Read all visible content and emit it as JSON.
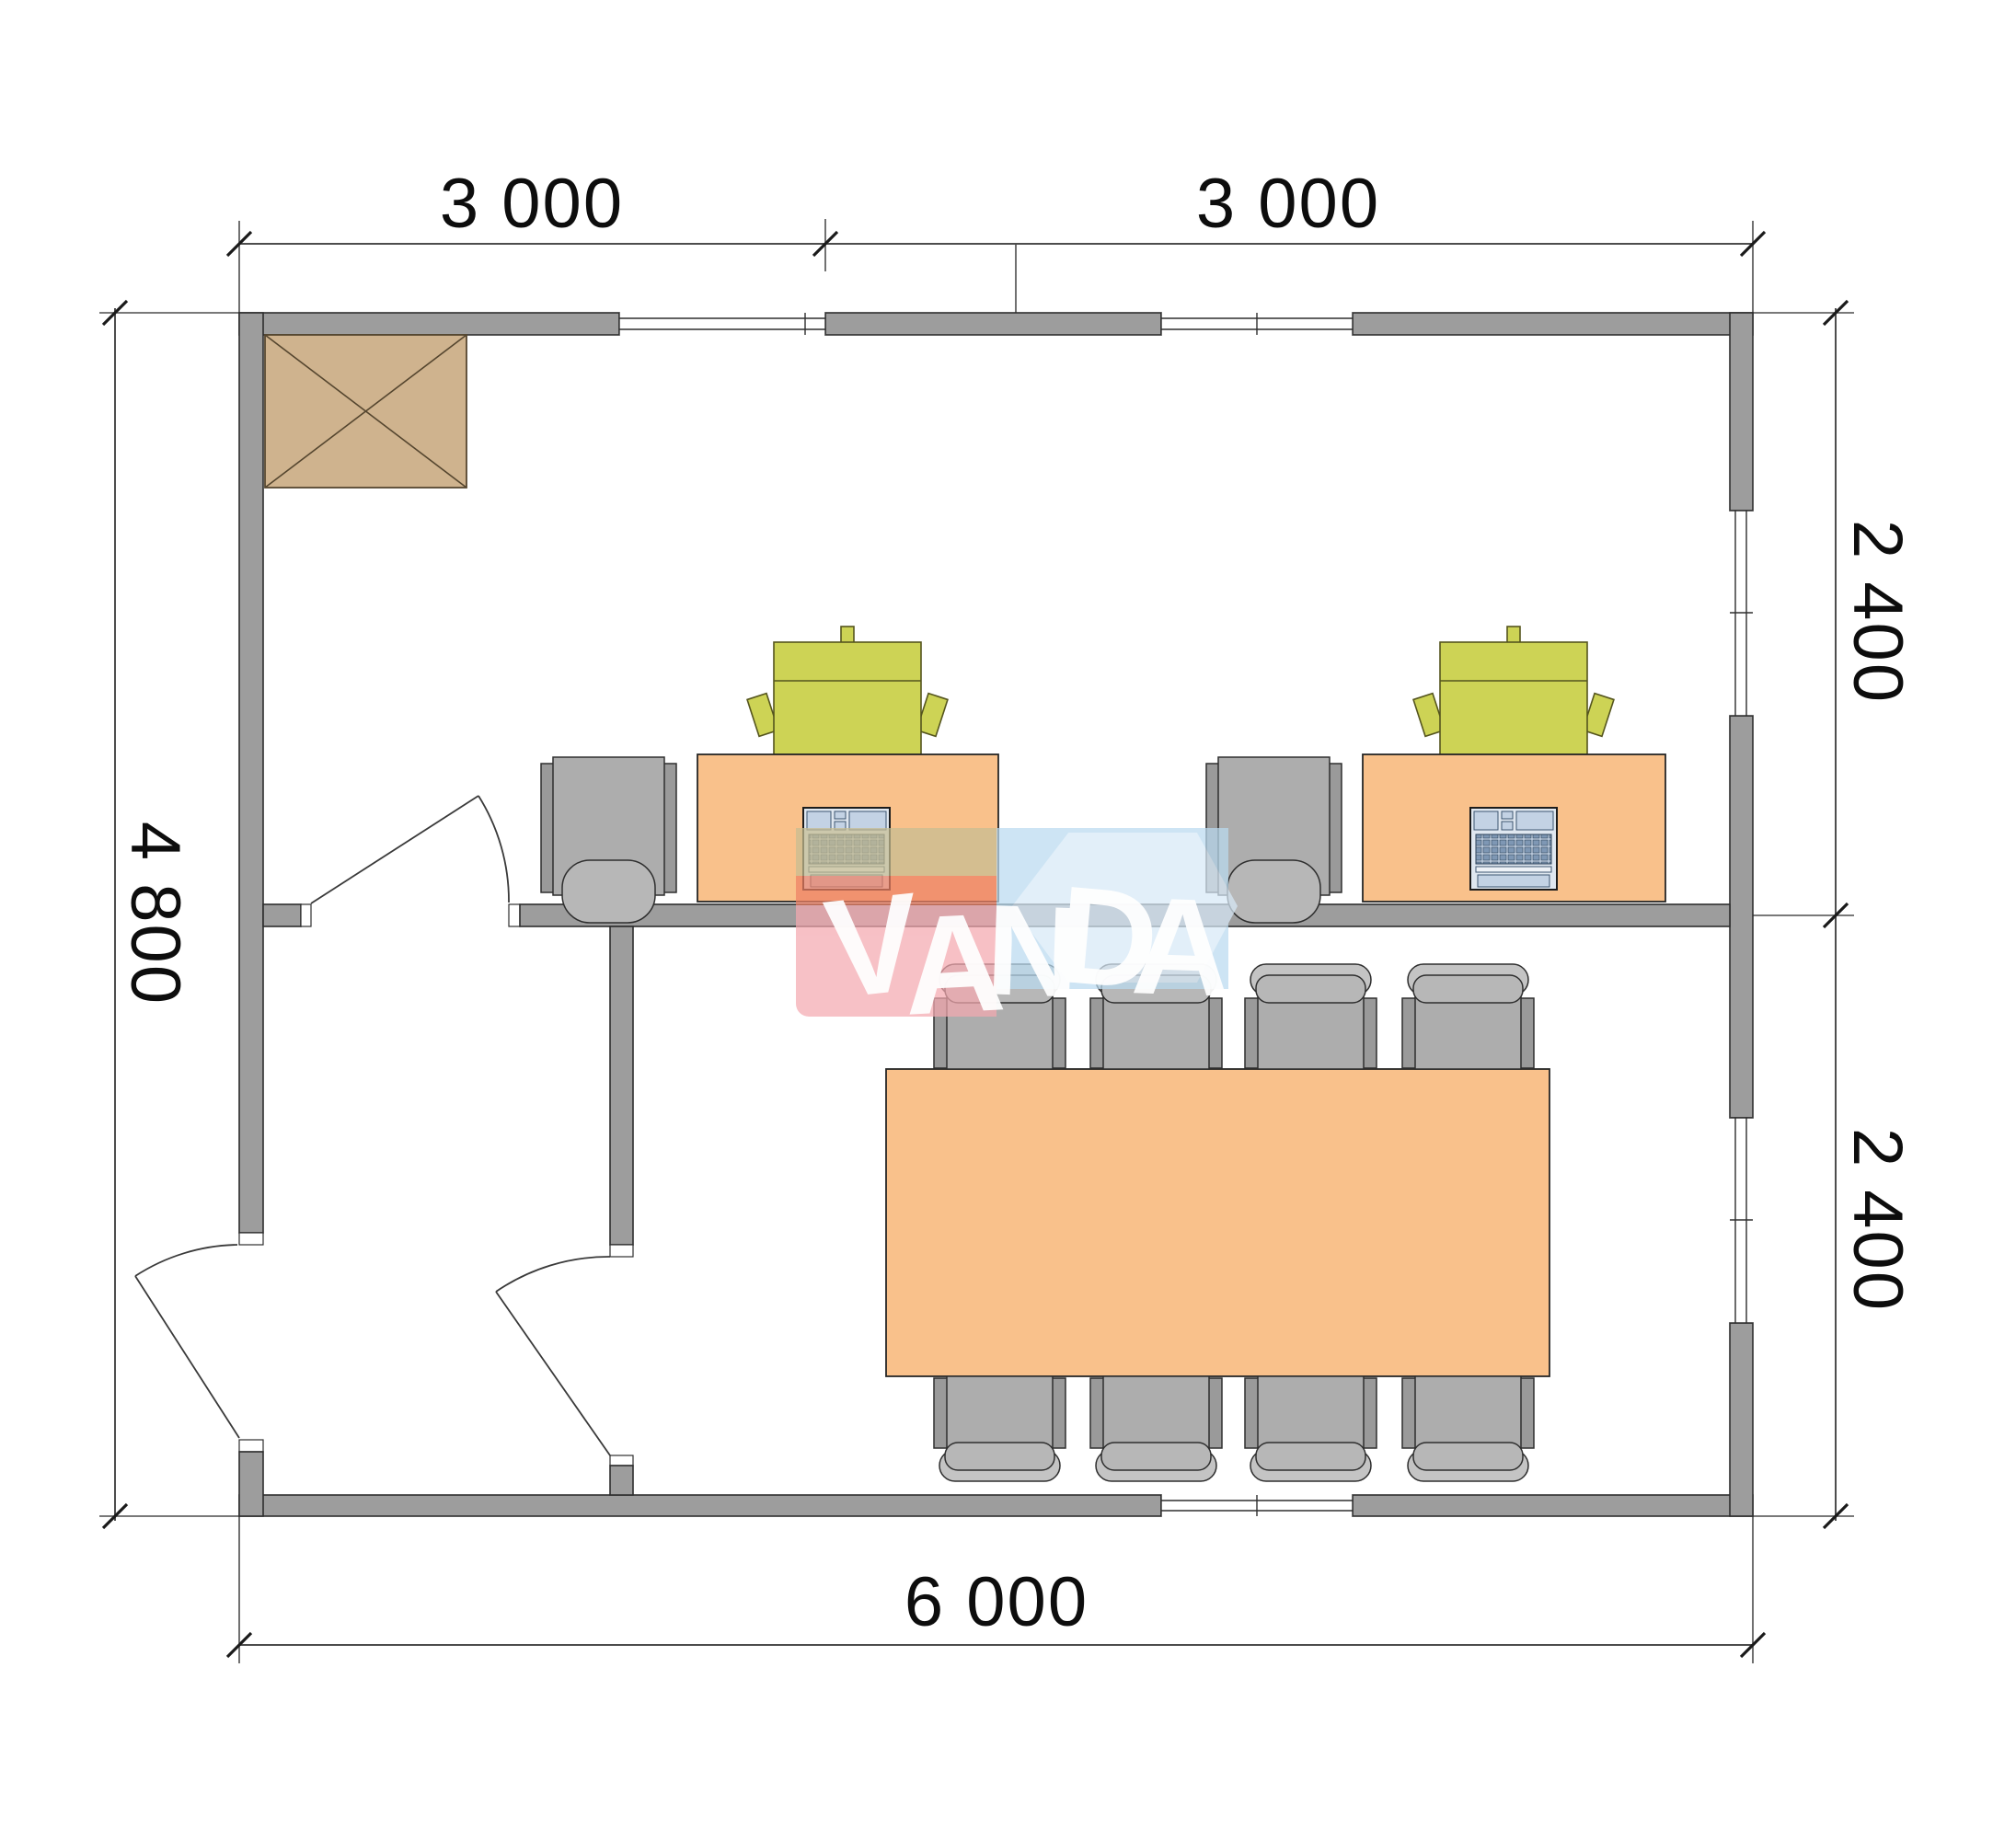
{
  "plan": {
    "title": "Modular office floor plan 6000 x 4800",
    "dimensions_mm": {
      "top": [
        "3 000",
        "3 000"
      ],
      "right": [
        "2 400",
        "2 400"
      ],
      "bottom": "6 000",
      "left": "4 800"
    },
    "rooms": [
      {
        "name": "office",
        "furniture": [
          "cabinet-crossed-box",
          "desk",
          "desk",
          "executive-chair-green",
          "executive-chair-green",
          "task-chair-gray",
          "task-chair-gray",
          "laptop",
          "laptop"
        ]
      },
      {
        "name": "meeting-room",
        "furniture": [
          "meeting-table",
          "chair",
          "chair",
          "chair",
          "chair",
          "chair",
          "chair",
          "chair",
          "chair"
        ]
      },
      {
        "name": "entrance-hall",
        "furniture": []
      }
    ],
    "openings": {
      "doors": 3,
      "windows": 5
    }
  },
  "watermark": {
    "text": "VANDA",
    "letters": [
      "V",
      "A",
      "N",
      "D",
      "A"
    ]
  },
  "colors": {
    "wall": "#9d9d9d",
    "wall-line": "#2e2e2e",
    "dim-line": "#4d4d4d",
    "tick": "#1a1a1a",
    "text": "#0d0d0d",
    "furn-orange": "#f9c18b",
    "furn-outline": "#262626",
    "chair-green": "#cdd355",
    "green-line": "#55551e",
    "chair-gray": "#adadad",
    "chair-gray-light": "#c4c4c4",
    "chair-gray-mid": "#b7b7b7",
    "chair-post": "#9a9a9a",
    "box-tan": "#cfb38e",
    "box-line": "#55462f",
    "laptop-body": "#dfe7f0",
    "laptop-mid": "#c3d2e4",
    "laptop-dark": "#7e97b4",
    "wm-pink": "#f4a9b0",
    "wm-salmon": "#ee8165",
    "wm-tan": "#c6bd92",
    "wm-blue": "#badbf0",
    "wm-blue-light": "#d8e9f7",
    "wm-white": "#ffffff"
  }
}
